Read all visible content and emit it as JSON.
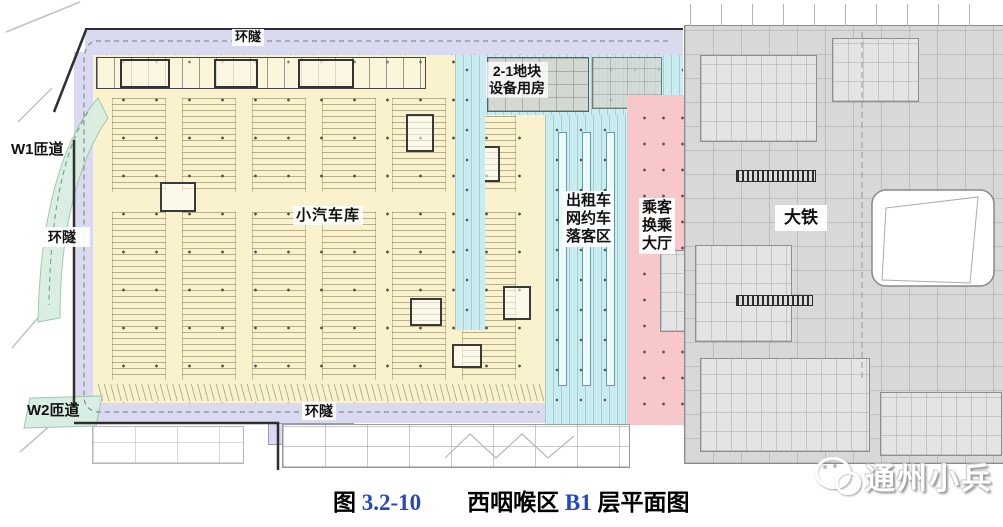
{
  "figure": {
    "caption": {
      "figure_word": "图",
      "figure_number": "3.2-10",
      "title_region": "西咽喉区",
      "title_level": "B1",
      "title_suffix": "层平面图",
      "number_color": "#2446c8"
    },
    "watermark": {
      "text": "通州小兵",
      "icon": "wechat-logo-icon"
    }
  },
  "plan": {
    "labels": {
      "ring_tunnel_top": "环隧",
      "ring_tunnel_left": "环隧",
      "ring_tunnel_bottom": "环隧",
      "ramp_w1": "W1匝道",
      "ramp_w2": "W2匝道",
      "car_garage": "小汽车库",
      "taxi_dropoff_lines": [
        "出租车",
        "网约车",
        "落客区"
      ],
      "transfer_hall_lines": [
        "乘客",
        "换乘",
        "大厅"
      ],
      "equipment_room_lines": [
        "2-1地块",
        "设备用房"
      ],
      "mainline_rail": "大铁"
    },
    "zone_colors": {
      "ring_tunnel": "#d9d9ef",
      "car_garage": "#faf1cd",
      "taxi_dropoff": "#c9ecf1",
      "transfer_hall": "#f8c7ca",
      "mainline_rail": "#d8d8d8",
      "ramp_green": "#d9eee2",
      "equipment_gray": "#d3d8d3"
    }
  }
}
